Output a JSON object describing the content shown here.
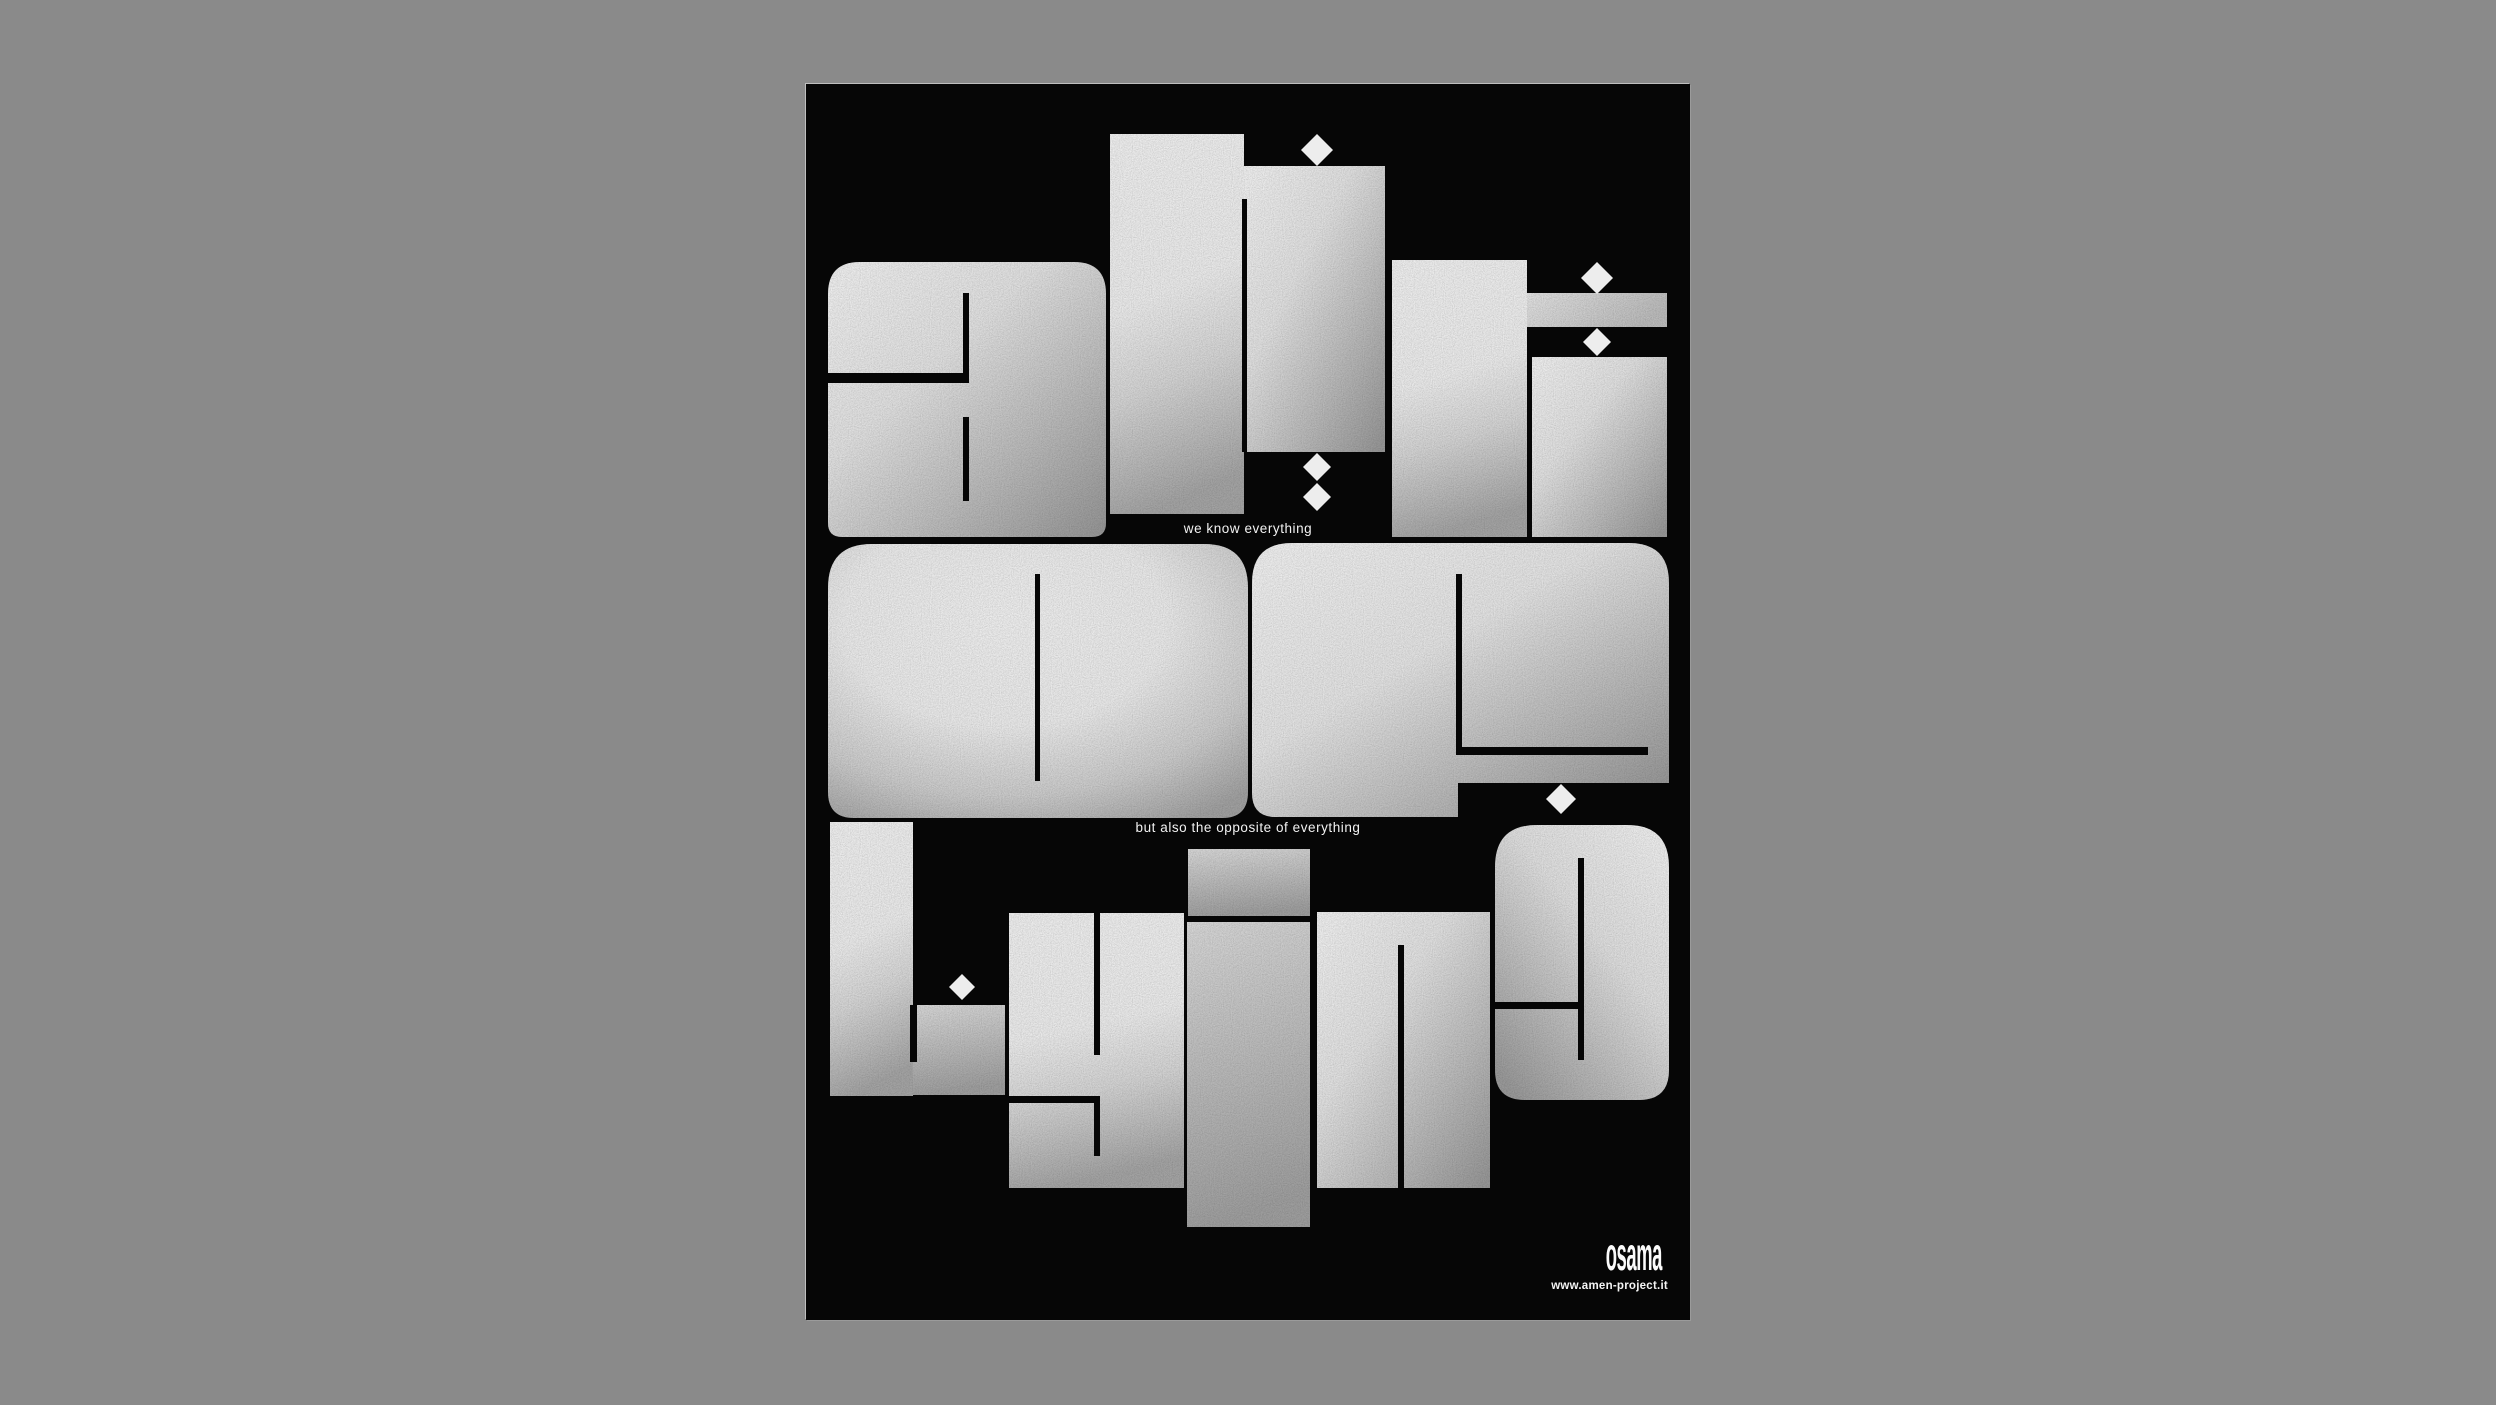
{
  "page": {
    "background_color": "#8a8a8a",
    "description": "experimental typographic poster centered on gray background"
  },
  "poster": {
    "colors": {
      "poster_background": "#060606",
      "letter_highlight": "#ffffff",
      "letter_shadow_gray": "#9a9a9a",
      "caption_text": "#f2f2f2"
    },
    "words": [
      {
        "row": 1,
        "word": "ant"
      },
      {
        "row": 2,
        "word": "op"
      },
      {
        "row": 3,
        "word": "lying"
      }
    ],
    "ornaments": {
      "diamond_count": 7
    },
    "captions": {
      "row1_caption": "we know everything",
      "row2_caption": "but also the opposite of everything"
    },
    "footer": {
      "logo_text": "osama",
      "website": "www.amen-project.it"
    }
  }
}
